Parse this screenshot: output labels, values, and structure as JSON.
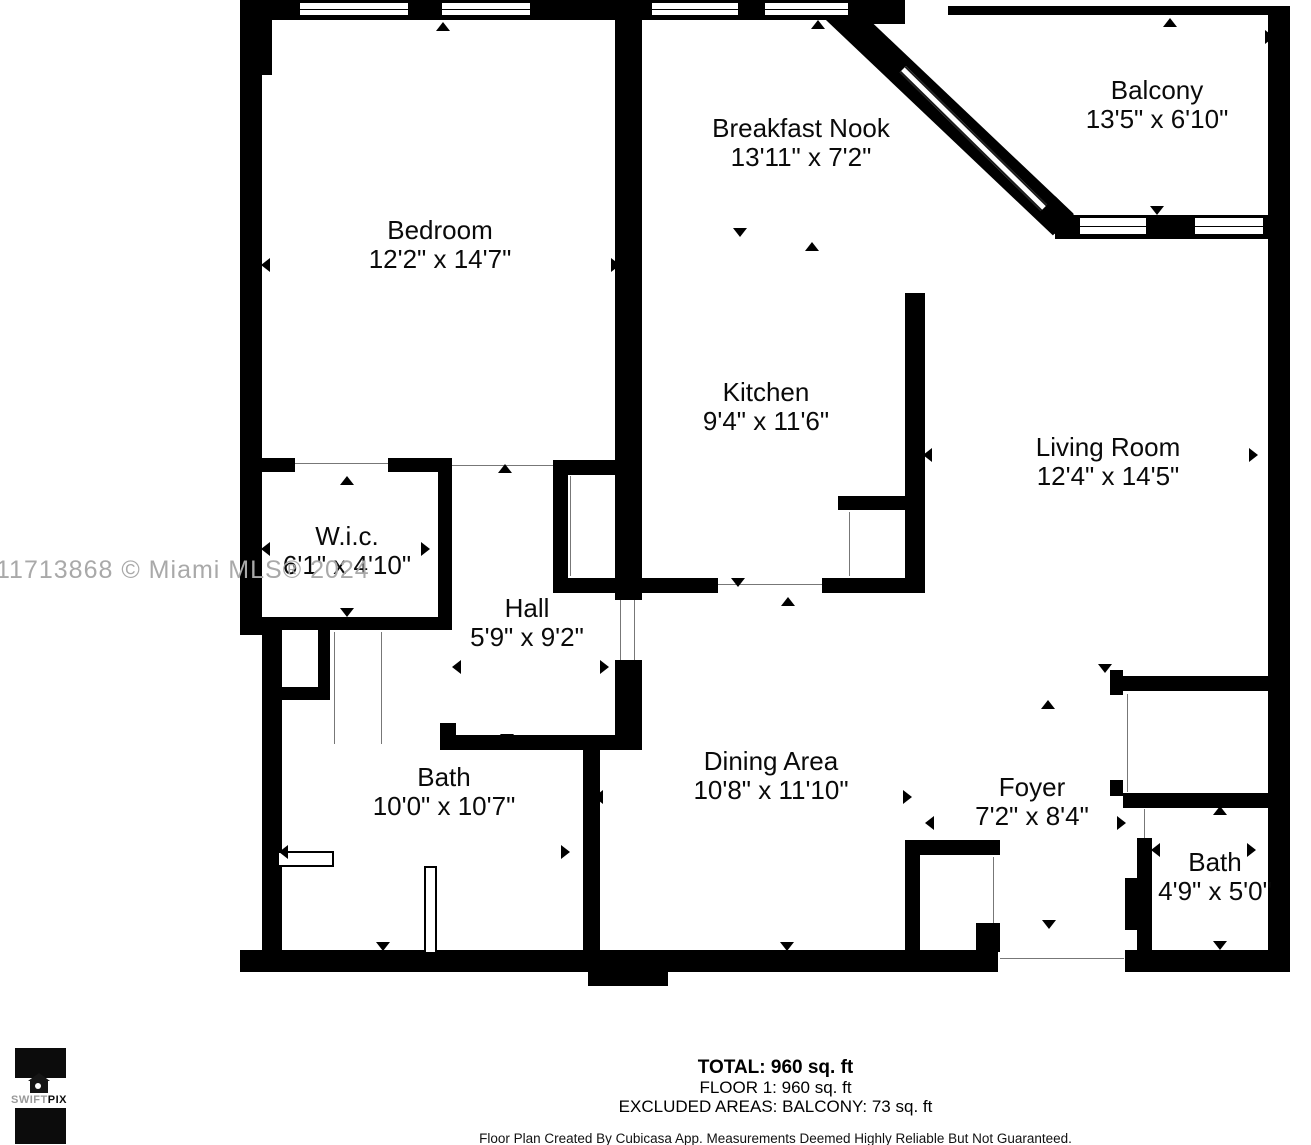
{
  "plan": {
    "rooms": [
      {
        "id": "bedroom",
        "name": "Bedroom",
        "dims": "12'2\" x 14'7\"",
        "cx": 440,
        "top": 216
      },
      {
        "id": "breakfast-nook",
        "name": "Breakfast Nook",
        "dims": "13'11\" x 7'2\"",
        "cx": 801,
        "top": 114
      },
      {
        "id": "balcony",
        "name": "Balcony",
        "dims": "13'5\" x 6'10\"",
        "cx": 1157,
        "top": 76
      },
      {
        "id": "kitchen",
        "name": "Kitchen",
        "dims": "9'4\" x 11'6\"",
        "cx": 766,
        "top": 378
      },
      {
        "id": "living-room",
        "name": "Living Room",
        "dims": "12'4\" x 14'5\"",
        "cx": 1108,
        "top": 433
      },
      {
        "id": "wic",
        "name": "W.i.c.",
        "dims": "6'1\" x 4'10\"",
        "cx": 347,
        "top": 522
      },
      {
        "id": "hall",
        "name": "Hall",
        "dims": "5'9\" x 9'2\"",
        "cx": 527,
        "top": 594
      },
      {
        "id": "bath",
        "name": "Bath",
        "dims": "10'0\" x 10'7\"",
        "cx": 444,
        "top": 763
      },
      {
        "id": "dining-area",
        "name": "Dining Area",
        "dims": "10'8\" x 11'10\"",
        "cx": 771,
        "top": 747
      },
      {
        "id": "foyer",
        "name": "Foyer",
        "dims": "7'2\" x 8'4\"",
        "cx": 1032,
        "top": 773
      },
      {
        "id": "bath-2",
        "name": "Bath",
        "dims": "4'9\" x 5'0\"",
        "cx": 1215,
        "top": 848
      }
    ],
    "watermark": "11713868 © Miami MLS® 2024",
    "footer": {
      "total": "TOTAL: 960 sq. ft",
      "floor": "FLOOR 1: 960 sq. ft",
      "excluded": "EXCLUDED AREAS: BALCONY: 73 sq. ft",
      "disclaimer": "Floor Plan Created By Cubicasa App. Measurements Deemed Highly Reliable But Not Guaranteed."
    },
    "logo": {
      "swift": "SWIFT",
      "pix": "PIX"
    }
  }
}
